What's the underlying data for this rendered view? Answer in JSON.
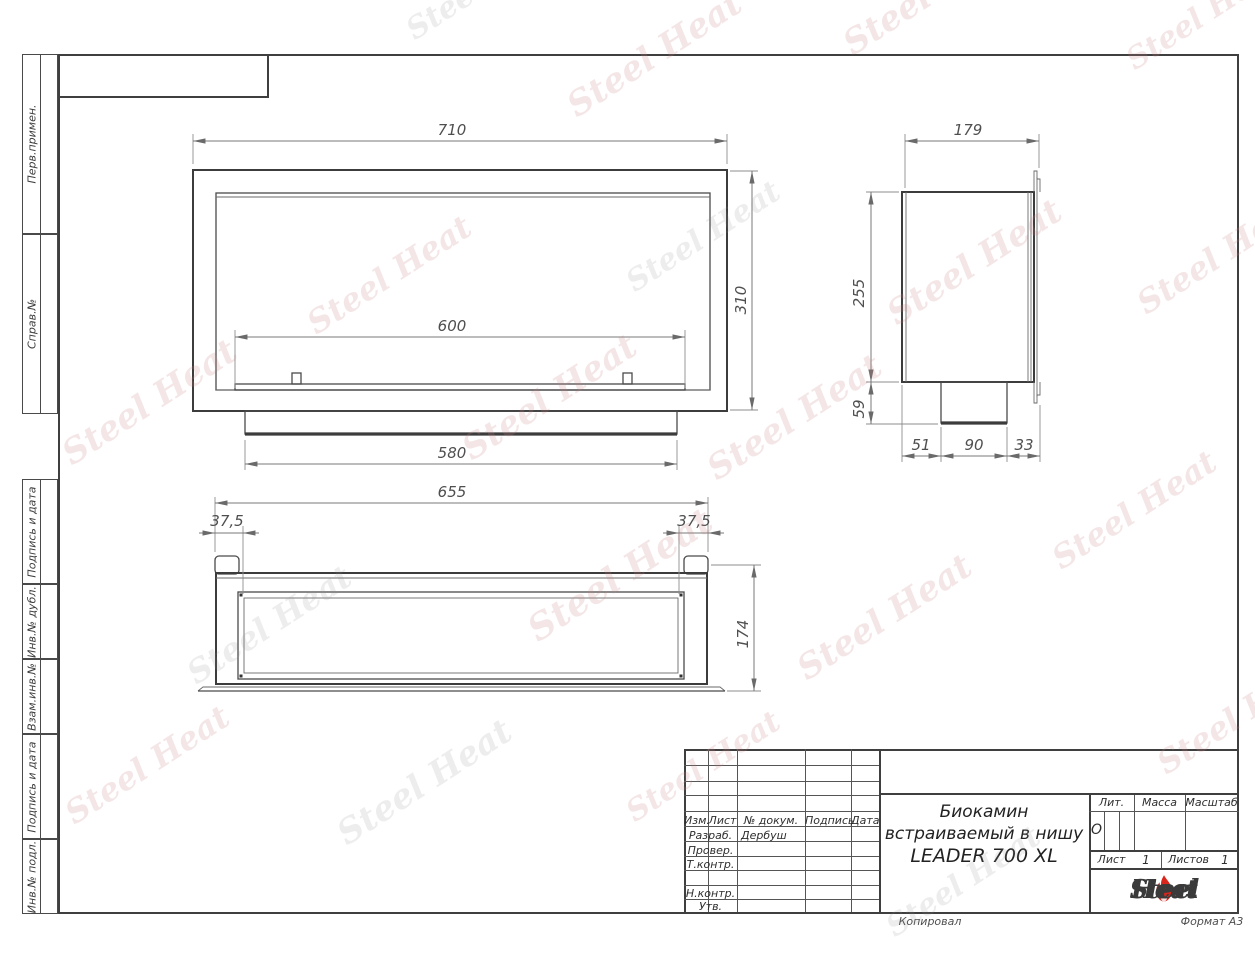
{
  "watermark": {
    "text": "Steel Heat"
  },
  "frame": {
    "left_labels": [
      "Перв.примен.",
      "Справ.№",
      "Подпись и дата",
      "Инв.№ дубл.",
      "Взам.инв.№",
      "Подпись и дата",
      "Инв.№ подл."
    ],
    "footer": {
      "copied": "Копировал",
      "format": "Формат А3"
    }
  },
  "views": {
    "front": {
      "width": "710",
      "height": "310",
      "burner_width": "600",
      "base_width": "580"
    },
    "side": {
      "depth": "179",
      "height": "255",
      "burner_box_height": "59",
      "offset_left": "51",
      "burner_box_depth": "90",
      "offset_right": "33"
    },
    "top": {
      "width": "655",
      "flange_left": "37,5",
      "flange_right": "37,5",
      "depth": "174"
    }
  },
  "title_block": {
    "header": {
      "izm": "Изм.",
      "list": "Лист",
      "doc": "№ докум.",
      "podpis": "Подпись",
      "data": "Дата"
    },
    "rows": [
      {
        "label": "Разраб.",
        "name": "Дербуш"
      },
      {
        "label": "Провер.",
        "name": ""
      },
      {
        "label": "Т.контр.",
        "name": ""
      },
      {
        "label": "",
        "name": ""
      },
      {
        "label": "Н.контр.",
        "name": ""
      },
      {
        "label": "Утв.",
        "name": ""
      }
    ],
    "product_title": [
      "Биокамин",
      "встраиваемый в нишу",
      "LEADER 700 XL"
    ],
    "lit_label": "Лит.",
    "lit_value": "О",
    "mass_label": "Масса",
    "scale_label": "Масштаб",
    "sheet_label": "Лист",
    "sheet_value": "1",
    "sheets_label": "Листов",
    "sheets_value": "1",
    "logo": {
      "steel": "Steel",
      "heat": "Heat"
    },
    "accent_color": "#d8261c"
  }
}
